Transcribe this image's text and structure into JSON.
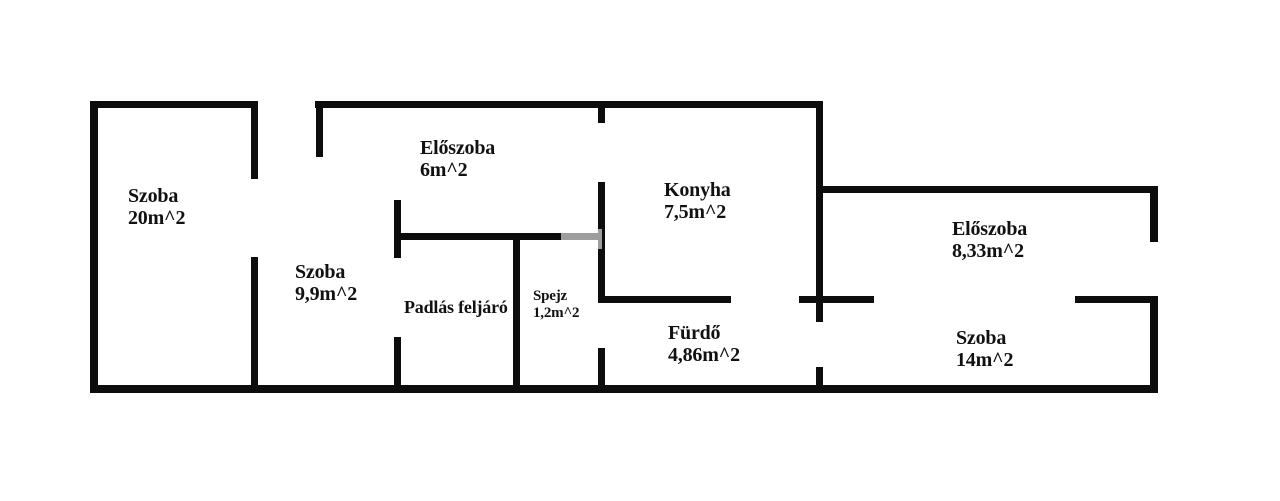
{
  "canvas": {
    "width": 1280,
    "height": 501,
    "background_color": "#ffffff",
    "wall_color": "#0d0d0d",
    "text_color": "#111111"
  },
  "title": "Floor plan (Hungarian apartment layout)",
  "rooms": [
    {
      "id": "szoba-20",
      "name": "Szoba",
      "area": "20m^2",
      "x": 128,
      "y": 185,
      "font": 20
    },
    {
      "id": "eloszoba-6",
      "name": "Előszoba",
      "area": "6m^2",
      "x": 420,
      "y": 137,
      "font": 20
    },
    {
      "id": "konyha-75",
      "name": "Konyha",
      "area": "7,5m^2",
      "x": 664,
      "y": 179,
      "font": 20
    },
    {
      "id": "eloszoba-833",
      "name": "Előszoba",
      "area": "8,33m^2",
      "x": 952,
      "y": 218,
      "font": 20
    },
    {
      "id": "szoba-99",
      "name": "Szoba",
      "area": "9,9m^2",
      "x": 295,
      "y": 261,
      "font": 20
    },
    {
      "id": "padlas-feljaro",
      "name": "Padlás feljáró",
      "area": "",
      "x": 404,
      "y": 298,
      "font": 18
    },
    {
      "id": "spejz-12",
      "name": "Spejz",
      "area": "1,2m^2",
      "x": 533,
      "y": 288,
      "font": 15
    },
    {
      "id": "furdo-486",
      "name": "Fürdő",
      "area": "4,86m^2",
      "x": 668,
      "y": 322,
      "font": 20
    },
    {
      "id": "szoba-14",
      "name": "Szoba",
      "area": "14m^2",
      "x": 956,
      "y": 327,
      "font": 20
    }
  ],
  "walls": [
    {
      "name": "outer-top-left",
      "x": 90,
      "y": 101,
      "w": 167,
      "h": 7
    },
    {
      "name": "outer-top-mid",
      "x": 315,
      "y": 101,
      "w": 508,
      "h": 7
    },
    {
      "name": "outer-left",
      "x": 90,
      "y": 101,
      "w": 8,
      "h": 292
    },
    {
      "name": "outer-bottom",
      "x": 90,
      "y": 385,
      "w": 1068,
      "h": 8
    },
    {
      "name": "right-wing-top",
      "x": 816,
      "y": 186,
      "w": 342,
      "h": 7
    },
    {
      "name": "outer-right-upper",
      "x": 1150,
      "y": 186,
      "w": 8,
      "h": 56
    },
    {
      "name": "outer-right-lower",
      "x": 1150,
      "y": 296,
      "w": 8,
      "h": 97
    },
    {
      "name": "divider-szoba20-upper",
      "x": 251,
      "y": 101,
      "w": 7,
      "h": 78
    },
    {
      "name": "divider-szoba20-lower",
      "x": 251,
      "y": 257,
      "w": 7,
      "h": 136
    },
    {
      "name": "entry-stub",
      "x": 316,
      "y": 101,
      "w": 7,
      "h": 56
    },
    {
      "name": "divider-padlas-upper",
      "x": 394,
      "y": 200,
      "w": 7,
      "h": 58
    },
    {
      "name": "divider-padlas-lower",
      "x": 394,
      "y": 337,
      "w": 7,
      "h": 56
    },
    {
      "name": "spejz-top",
      "x": 394,
      "y": 233,
      "w": 211,
      "h": 7
    },
    {
      "name": "divider-spejz",
      "x": 513,
      "y": 233,
      "w": 7,
      "h": 160
    },
    {
      "name": "divider-konyha-stub",
      "x": 598,
      "y": 101,
      "w": 7,
      "h": 22
    },
    {
      "name": "divider-konyha-mid",
      "x": 598,
      "y": 182,
      "w": 7,
      "h": 121
    },
    {
      "name": "divider-konyha-lower",
      "x": 598,
      "y": 348,
      "w": 7,
      "h": 45
    },
    {
      "name": "furdo-top-left",
      "x": 598,
      "y": 296,
      "w": 133,
      "h": 7
    },
    {
      "name": "furdo-top-right",
      "x": 799,
      "y": 296,
      "w": 75,
      "h": 7
    },
    {
      "name": "szoba14-top-right",
      "x": 1075,
      "y": 296,
      "w": 83,
      "h": 7
    },
    {
      "name": "divider-konyha-right-upper",
      "x": 816,
      "y": 101,
      "w": 7,
      "h": 221
    },
    {
      "name": "divider-konyha-right-lower",
      "x": 816,
      "y": 367,
      "w": 7,
      "h": 26
    }
  ],
  "watermark": {
    "x": 561,
    "y": 229,
    "w": 41,
    "h": 20
  }
}
